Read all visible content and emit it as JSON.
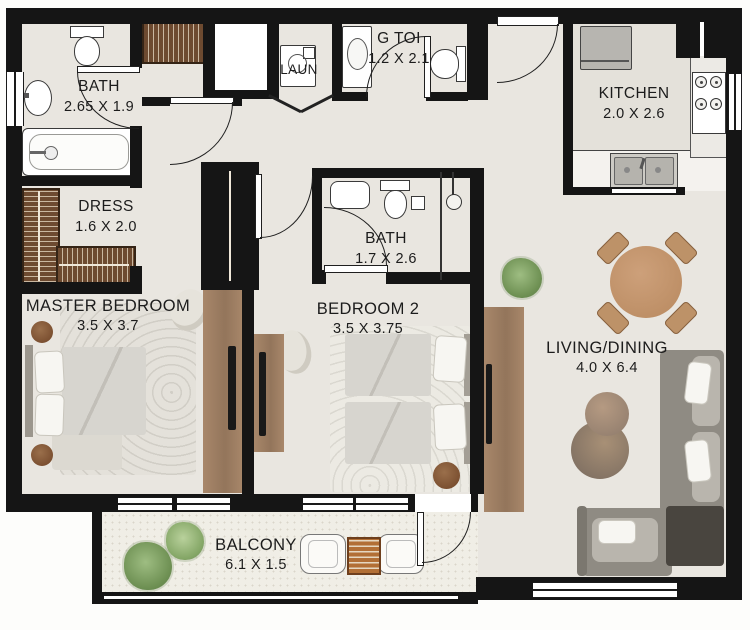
{
  "rooms": {
    "bath1": {
      "name": "BATH",
      "dims": "2.65 X 1.9"
    },
    "dress": {
      "name": "DRESS",
      "dims": "1.6 X 2.0"
    },
    "master_bedroom": {
      "name": "MASTER BEDROOM",
      "dims": "3.5 X 3.7"
    },
    "laundry": {
      "name": "LAUN"
    },
    "guest_toilet": {
      "name": "G TOI",
      "dims": "1.2 X 2.1"
    },
    "kitchen": {
      "name": "KITCHEN",
      "dims": "2.0 X 2.6"
    },
    "bath2": {
      "name": "BATH",
      "dims": "1.7 X 2.6"
    },
    "bedroom2": {
      "name": "BEDROOM 2",
      "dims": "3.5 X 3.75"
    },
    "living_dining": {
      "name": "LIVING/DINING",
      "dims": "4.0 X 6.4"
    },
    "balcony": {
      "name": "BALCONY",
      "dims": "6.1 X 1.5"
    }
  },
  "colors": {
    "wall": "#151515",
    "floor": "#e9e6e0",
    "kitchen_floor": "#e4e1da",
    "balcony_floor": "#f0eee6",
    "wardrobe_wood": "#6d4a30",
    "console_wood": "#a8876a",
    "sofa_gray": "#8f8b83",
    "dining_table_tan": "#c49c74",
    "plant_green": "#87a76c",
    "fixture_white": "#ffffff"
  }
}
